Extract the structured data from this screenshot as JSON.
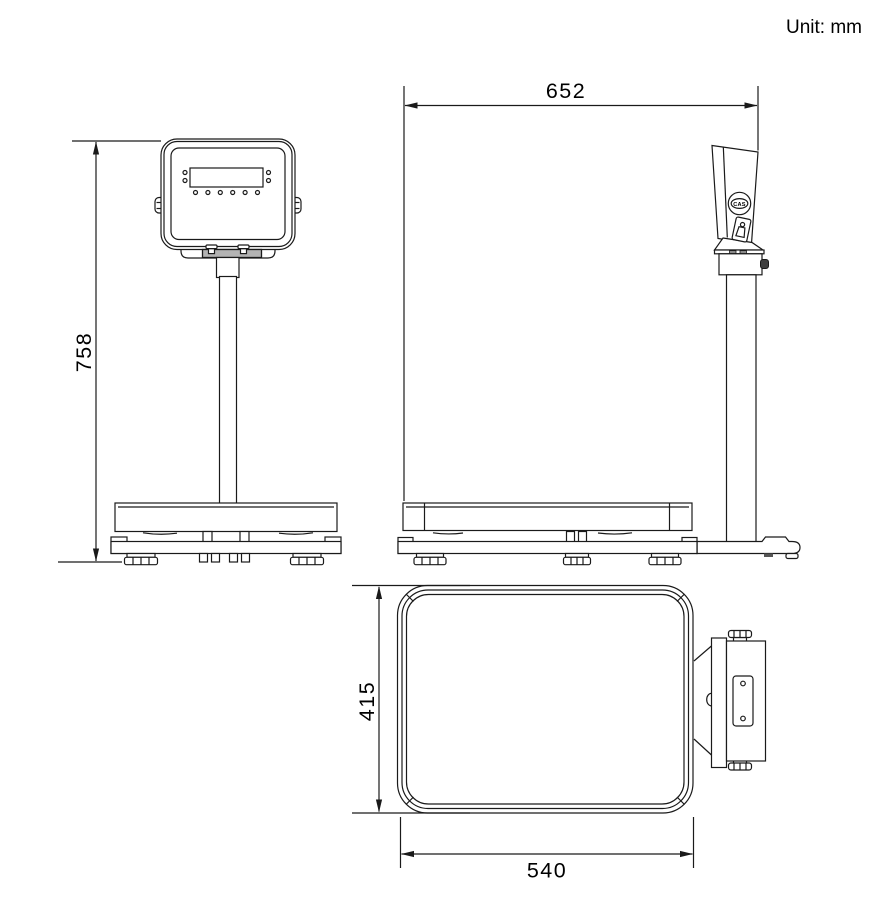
{
  "unit_label": "Unit: mm",
  "brand": "CAS",
  "dimensions": {
    "overall_height": "758",
    "overall_depth": "652",
    "platform_depth": "415",
    "platform_width": "540"
  }
}
